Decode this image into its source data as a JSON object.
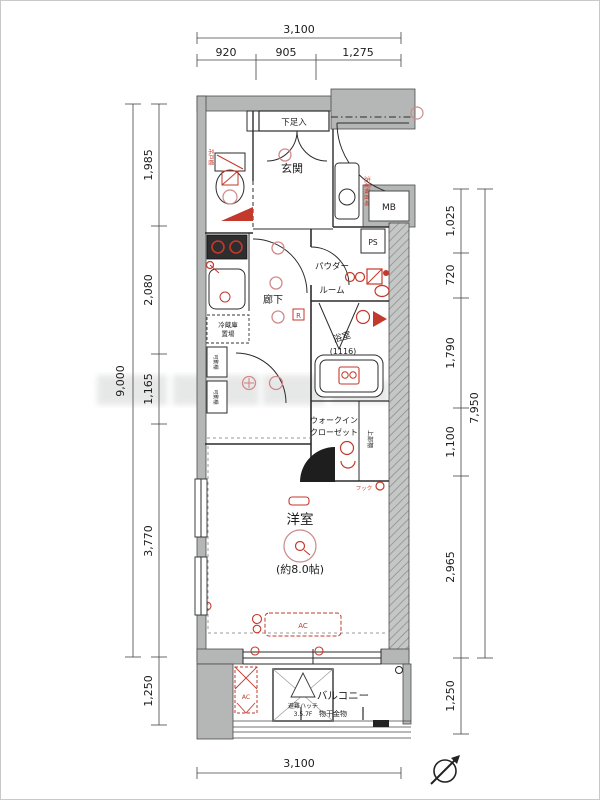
{
  "colors": {
    "wall_fill": "#b4b7b6",
    "wall_stroke": "#4a4c4b",
    "line": "#2b2b2b",
    "fixture_red": "#c3392b",
    "light_pink": "#d08a8a",
    "dimension_text": "#1c1c1c"
  },
  "dimensions": {
    "top": {
      "total": "3,100",
      "segments": [
        "920",
        "905",
        "1,275"
      ]
    },
    "bottom": {
      "total": "3,100"
    },
    "left": {
      "total": "9,000",
      "segments": [
        "1,985",
        "2,080",
        "1,165",
        "3,770",
        "1,250"
      ]
    },
    "right": {
      "total": "7,950",
      "segments": [
        "1,025",
        "720",
        "1,790",
        "1,100",
        "2,965",
        "1,250"
      ]
    }
  },
  "labels": {
    "entrance": "玄関",
    "shoe_cabinet": "下足入",
    "hallway": "廊下",
    "powder_room_1": "パウダー",
    "powder_room_2": "ルーム",
    "bathroom": "浴室",
    "bathroom_size": "(1116)",
    "closet_1": "ウォークイン",
    "closet_2": "クローゼット",
    "upper_shelf": "上部棚",
    "hook": "フック",
    "western_room": "洋室",
    "western_room_size": "(約8.0帖)",
    "balcony": "バルコニー",
    "drying_fixture": "物干金物",
    "evacuation_hatch_1": "避難ハッチ",
    "evacuation_hatch_2": "3.5.7F",
    "meter_box": "MB",
    "pipe_space": "PS",
    "fridge_1": "冷蔵庫",
    "fridge_2": "置場",
    "washer": "洗濯機置場",
    "hanging_cabinet": "吊戸棚",
    "movable_shelf_1": "可動棚",
    "movable_shelf_2": "可動棚",
    "air_con_room": "AC",
    "air_con_balcony": "AC",
    "relay_mark": "R"
  }
}
